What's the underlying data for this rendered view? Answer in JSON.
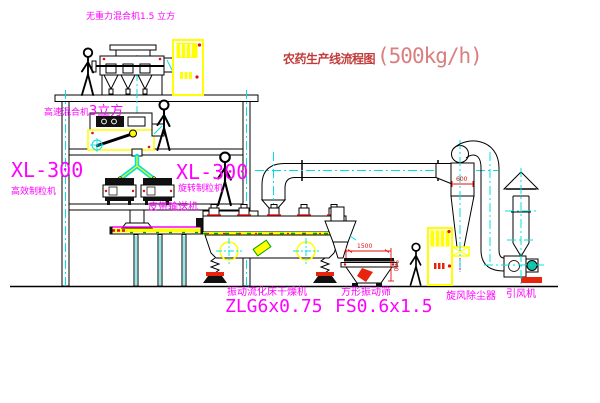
{
  "title": {
    "text": "农药生产线流程图",
    "capacity": "(500kg/h)"
  },
  "labels": {
    "top_mixer": "无重力混合机1.5 立方",
    "high_speed_mixer_name": "高速混合机",
    "high_speed_mixer_size": "3立方",
    "granulator_left_model": "XL-300",
    "granulator_left_name": "高效制粒机",
    "granulator_mid_model": "XL-300",
    "granulator_mid_name": "旋转制粒机",
    "belt_conveyor": "皮带输送机",
    "dryer_name": "振动流化床干燥机",
    "dryer_model": "ZLG6x0.75",
    "sieve_name": "方形振动筛",
    "sieve_model": "FS0.6x1.5",
    "cyclone": "旋风除尘器",
    "fan": "引风机"
  },
  "dimensions": {
    "sieve_length": "1500",
    "cyclone_diameter": "600",
    "sieve_height": "540"
  },
  "colors": {
    "label_magenta": "#ff00ff",
    "title_red": "#c23b3b",
    "capacity_red": "#d97f7f",
    "dimension_red": "#e01010",
    "centerline_cyan": "#00e0e0",
    "equipment_yellow": "#ffff00",
    "line_black": "#000000",
    "background": "#ffffff"
  }
}
